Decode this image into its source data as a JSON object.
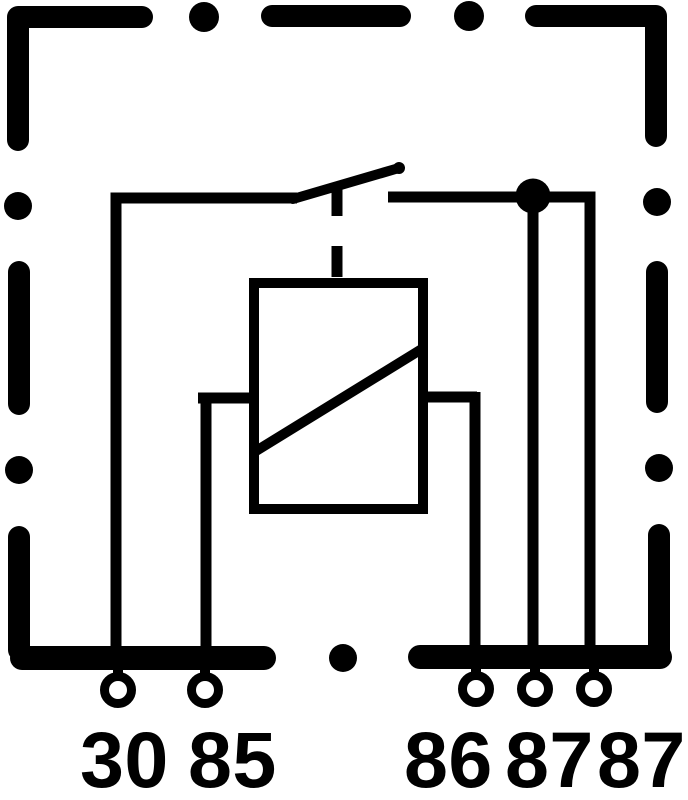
{
  "diagram": {
    "kind": "automotive-relay-pinout-schematic",
    "background_color": "#ffffff",
    "line_color": "#000000",
    "housing_style": "dashed-rounded-outline",
    "pin_count": "5",
    "terminals": [
      {
        "pin": "30",
        "label": "30"
      },
      {
        "pin": "85",
        "label": "85"
      },
      {
        "pin": "86",
        "label": "86"
      },
      {
        "pin": "87",
        "label": "87"
      },
      {
        "pin": "87",
        "label": "87"
      }
    ]
  }
}
